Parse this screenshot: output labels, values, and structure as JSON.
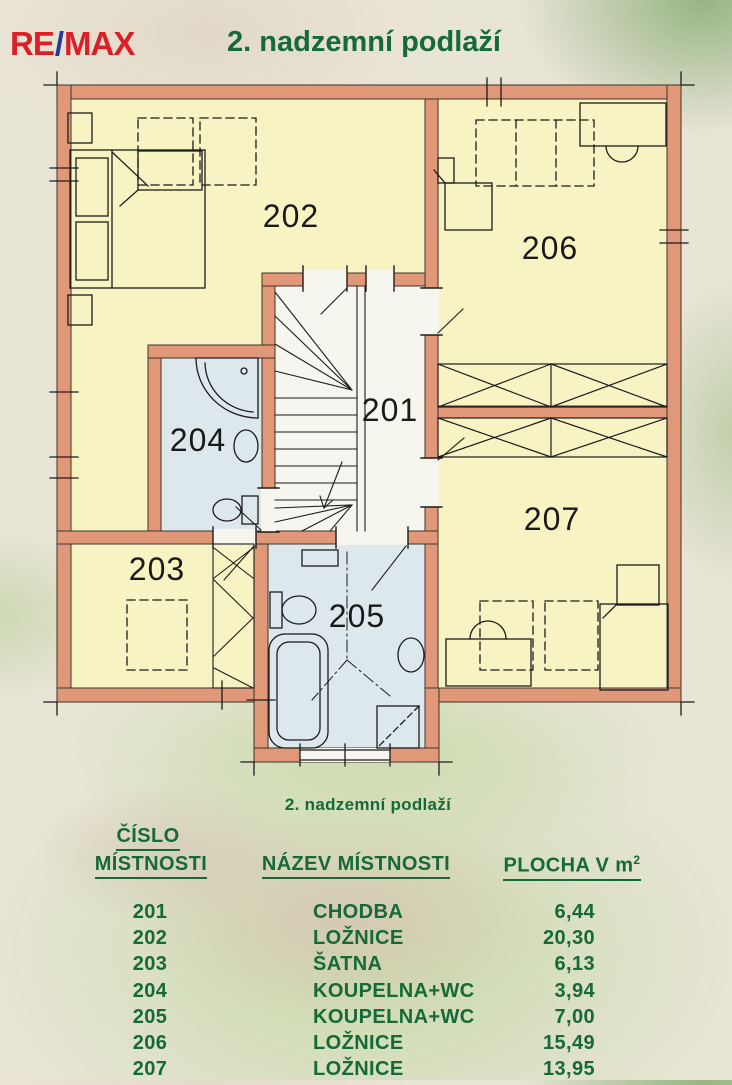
{
  "header": {
    "logo": {
      "re": "RE",
      "slash": "/",
      "max": "MAX"
    },
    "title": "2. nadzemní podlaží"
  },
  "floor_plan": {
    "rooms": [
      {
        "number": "201"
      },
      {
        "number": "202"
      },
      {
        "number": "203"
      },
      {
        "number": "204"
      },
      {
        "number": "205"
      },
      {
        "number": "206"
      },
      {
        "number": "207"
      }
    ]
  },
  "table": {
    "caption": "2. nadzemní podlaží",
    "headers": {
      "col1_line1": "ČÍSLO",
      "col1_line2": "MÍSTNOSTI",
      "col2": "NÁZEV MÍSTNOSTI",
      "col3": "PLOCHA V m",
      "col3_sup": "2"
    },
    "rows": [
      {
        "number": "201",
        "name": "CHODBA",
        "area": "6,44"
      },
      {
        "number": "202",
        "name": "LOŽNICE",
        "area": "20,30"
      },
      {
        "number": "203",
        "name": "ŠATNA",
        "area": "6,13"
      },
      {
        "number": "204",
        "name": "KOUPELNA+WC",
        "area": "3,94"
      },
      {
        "number": "205",
        "name": "KOUPELNA+WC",
        "area": "7,00"
      },
      {
        "number": "206",
        "name": "LOŽNICE",
        "area": "15,49"
      },
      {
        "number": "207",
        "name": "LOŽNICE",
        "area": "13,95"
      }
    ]
  },
  "colors": {
    "wall": "#e09878",
    "room_yellow": "#f8f3c3",
    "bathroom_blue": "#dde8ec",
    "hall_white": "#f6f5ee",
    "table_green": "#156a38",
    "logo_red": "#de1e26",
    "logo_blue": "#27389b"
  }
}
